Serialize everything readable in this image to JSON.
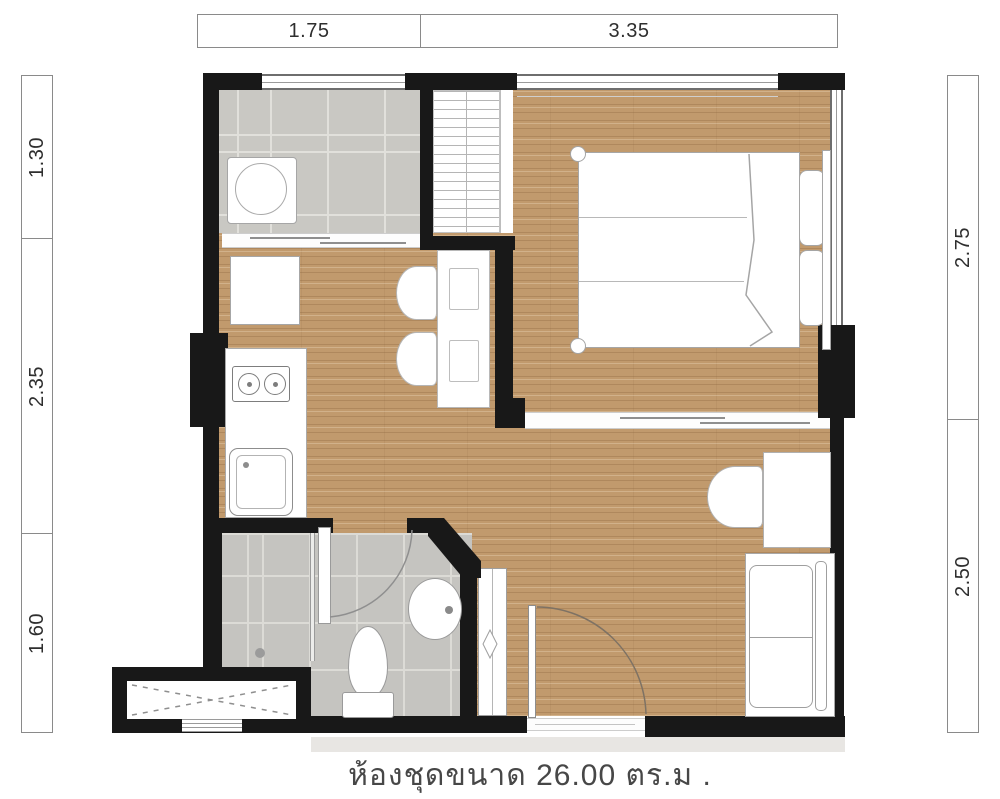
{
  "caption": "ห้องชุดขนาด 26.00 ตร.ม .",
  "unit_area_sqm": "26.00",
  "dimensions": {
    "top": [
      {
        "label": "1.75"
      },
      {
        "label": "3.35"
      }
    ],
    "left": [
      {
        "label": "1.30"
      },
      {
        "label": "2.35"
      },
      {
        "label": "1.60"
      }
    ],
    "right": [
      {
        "label": "2.75"
      },
      {
        "label": "2.50"
      }
    ]
  },
  "colors": {
    "wall": "#181818",
    "wood_floor": "#c19a6d",
    "tile_floor": "#c7c6c2",
    "dimension_text": "#2e2e2e",
    "caption_text": "#474747"
  }
}
